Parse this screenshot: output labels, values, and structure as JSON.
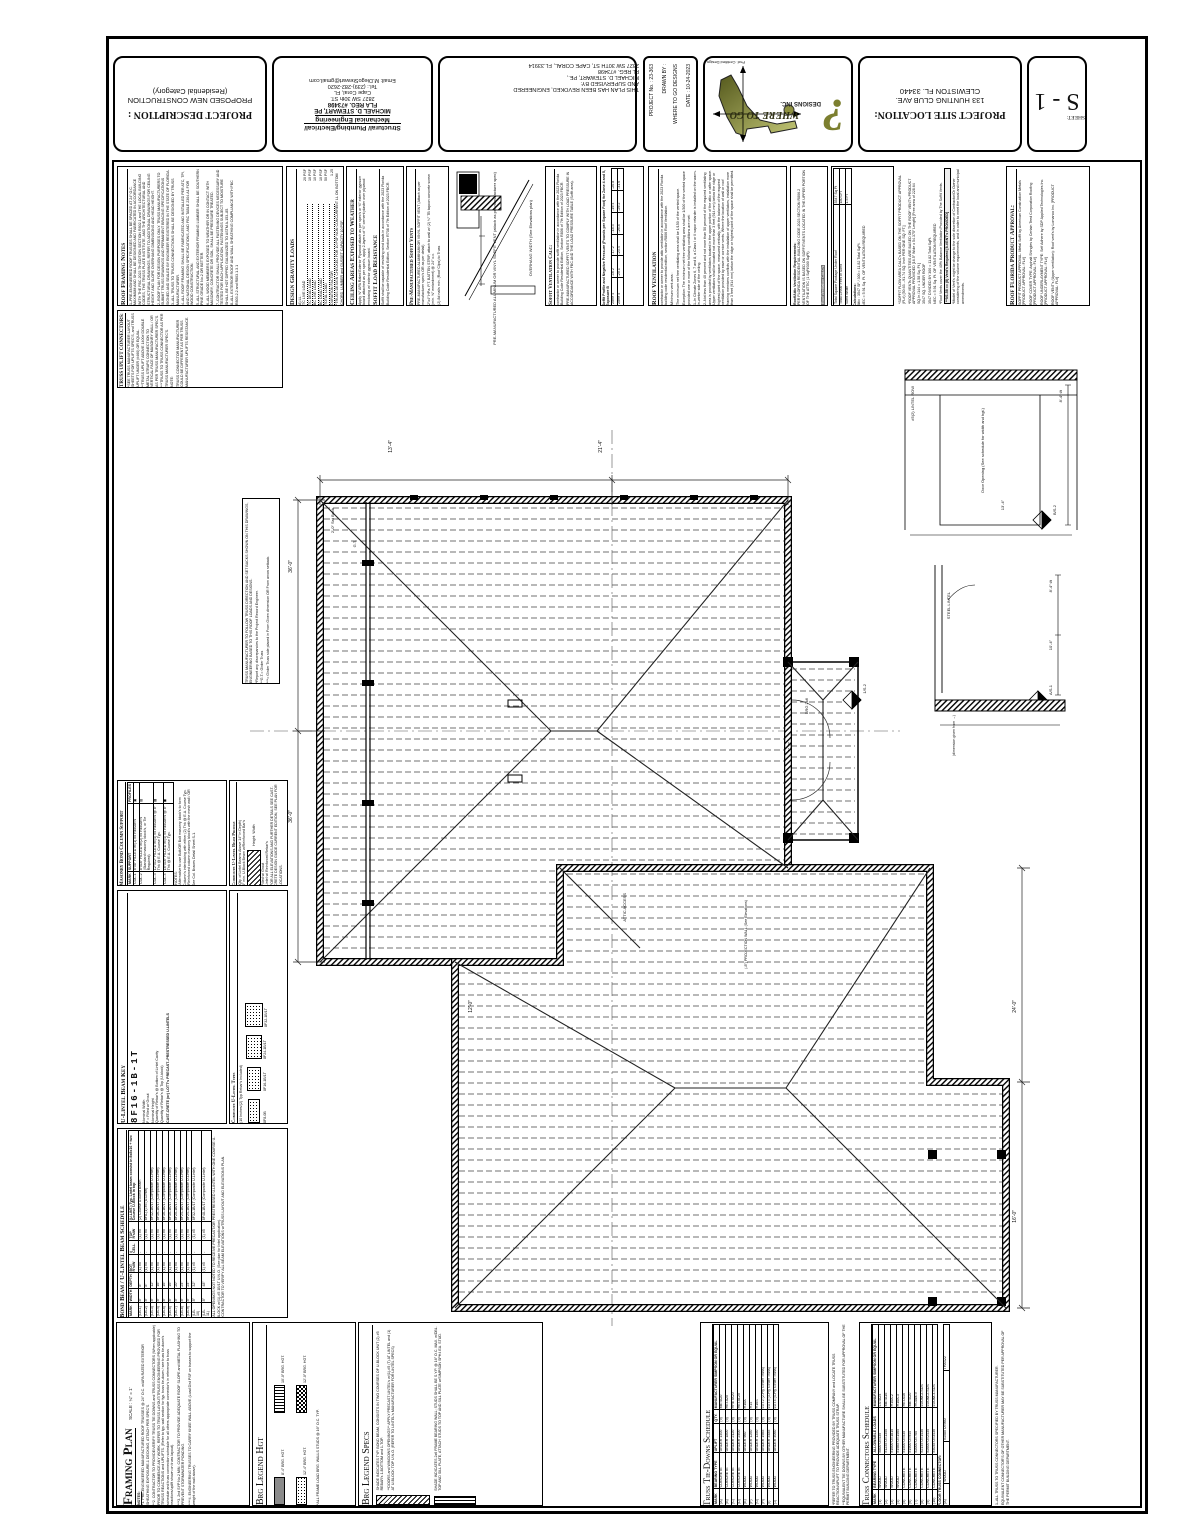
{
  "title_strip": {
    "project_description": {
      "label": "PROJECT DESCRIPTION :",
      "line1": "PROPOSED NEW CONSTRUCTION",
      "line2": "(Residential Category)"
    },
    "engineer": {
      "firm1": "Structural/ Plumbing/Electrical/",
      "firm2": "Mechanical Engineering",
      "name": "MICHAEL D. STEWART, PE",
      "reg": "FLA REG. #73498",
      "addr": "2827 SW 30th ST.",
      "city": "Cape Coral, FL",
      "tel": "Tel.: (239)-282-2620",
      "email": "Email: M.DiegoStewart@gmail.com"
    },
    "revision": {
      "l1": "THIS PLAN HAS BEEN REVOKED, ENGINEERED",
      "l2": "AND SUPERVISED BY:",
      "l3": "MICHAEL D. STEWART, PE.,",
      "l4": "FL REG. #73498",
      "l5": "2827 SW 30TH ST, CAPE CORAL, FL.33914"
    },
    "info": {
      "project_no": "PROJECT No. :  23-363",
      "drawn_by": "DRAWN BY :",
      "drawn_by_value": "WHERE TO GO DESIGNS",
      "date": "DATE :  10-24-2023"
    },
    "logo": {
      "title": "WHERE TO GO",
      "subtitle": "DESIGNS INC.",
      "tagline": "Prof. Certified Design"
    },
    "location": {
      "label": "PROJECT SITE LOCATION:",
      "l1": "133 HUNTING CLUB AVE.",
      "l2": "CLEWISTON FL. 33440"
    },
    "sheet": {
      "label": "SHEET:",
      "number": "S - 1"
    }
  },
  "notes": {
    "roof_framing": {
      "title": "Roof Framing Notes",
      "items": [
        "1–PRE-ENGINEERED ROOF TRUSSES SHALL BE SPACED AT 24″ O.C. MAXIMUM AND SHALL BE DESIGNED AND FABRICATED IN ACCORDANCE WITH THE FBC 2023 7th EDITION SECTION R802.1 and THE LOCAL BUILDING CODES, THE TRUSS PLATE INSTITUTE, AND THE ARCHITECTURAL AND STRUCTURAL DRAWINGS. REFER TO ADDITIONAL DRAWINGS FOR CEILING HEIGHT AND SLOPE OVERHANG DIMENSIONS AND HEAD HEIGHT.",
        "2–ROOF PLAN FOR DESIGN PURPOSES ONLY. TRUSS MANUFACTURERS TO SUBMIT TRUSS DRAWINGS AND PERMANENT BRACING SPECIFICATIONS SIGNED AND SEALED BY ENGINEER REGISTERED IN THE STATE OF FLORIDA.",
        "3–ALL TRUSS TO TRUSS CONNECTIONS SHALL BE DESIGNED BY TRUSS MANUFACTURER.",
        "4–ALL ROOF FRAMING SHALL BE FABRICATED AND INSTALLED PER ATC, TPI, AND NATIONAL DESIGN SPECIFICATIONS, AND FBC TABLE 2304.A1 FOR WOOD CONSTRUCTION.",
        "5–ALL STRUCTURAL AND EXTERIOR FRAMING LUMBER SHALL BE SOUTHERN PINE GRADE No.2 OR BETTER.",
        "6–ALL WOOD MEMBERS EXPOSED TO WEATHER OR IN CONTACT WITH MASONRY, CONCRETE OR SOIL, SHALL BE PRESSURE TREATED.",
        "7–CONTRACTOR SHALL PROVIDE ALL FASTENING DEVICES NECESSARY AND TESTED FOR EACH APPLICATION. FASTENINGS SUBJECT TO MOISTURE SHALL BE HOT DIPPED GALVANIZED TO ASTM A-153–85.",
        "8–ALL EXTERIOR ROOF AND WALL SHEATHING COMPLIANCE WITH FBC R803.2.2 and R803.1.3.1"
      ]
    },
    "truss_uplift": {
      "title": "TRUSS UPLIFT CONNECTORS:",
      "lines": [
        "*SEE TRUSS MANUFACTURER LAYOUT SHEETS FOR UPLIFTS SPEC'S, and TRUSS UPLIFT UNDER (#460) OR EQUAL.",
        "**TRUSS UPLIFT ABOVE 1400# DOUBLE METAL STRAPS CONNECTION TO VERTICAL FACE OF MASONRY WALL / OR AS PER TRUSS MANUFACTURER SPEC'S.",
        "***TRUSS TO TRUSS CONNECTOR AS PER TRUSS MANUFACTURER SPEC'S.",
        "NOTE:",
        "TRUSS CONNECTOR MANUFACTURER COULD BE DIFFERENT AS PER TRUSS MANUFACTURER UPLIFTS RESISTANCE."
      ]
    },
    "gravity": {
      "title": "Design Gravity Loads",
      "sub": "A) LL :",
      "rows": [
        [
          "TC LIVE LOAD",
          "20 PSF"
        ],
        [
          "TC DEAD LOAD",
          "10 PSF"
        ],
        [
          "BC LIVE LOAD",
          "10 PSF"
        ],
        [
          "BC DEAD LOAD",
          "10 PSF"
        ],
        [
          "TOTAL LOAD",
          "50 PSF"
        ],
        [
          "DURATION FACTOR",
          "1.25"
        ]
      ],
      "foot": "*TRUSS DESIGN CHECKED FOR 10 PSF NON CONCURRENT LL ON BOTTOM CHORD, LUMBER and GUSSET CAPACITY 10 PSF."
    },
    "ceiling": {
      "title": "Ceiling Areas Exposed to Weather",
      "body": "Apply ⅝″ APA Rated Exterior Plywood attach as per spec's or ⅝″ exterior gypsum board attached as per spec's, apply 2-layers of ⅝″ cement plaster over plywood enclosing w/ exterior gypsum board.",
      "title2": "Soffit Load Resistance",
      "body2": "Soffit shall be capable of resisting wind loads in accordance with the 2023 Florida Building Code Residential Edition, Section R708 of 7th Edition of 2023 FBCR."
    },
    "soffit_vents": {
      "title": "Pre-Manufactured Soffit Vents",
      "lines": [
        "PRE-MANUFACTURED ALUMINUM OR VINYL SOFFIT VENT (Attach as per manufacturer spec's OR as per detail)",
        "2″x4″ HPa. P.T. BATTEN STRIP, attach to wall w/ (2) ¼″ TB tapcon concrete screw (min. ⅝″ embedment) @ 24″ o.c.",
        "(2) 8d nails min. (Roof Clips) to Truss"
      ]
    },
    "detail_labels": {
      "a": "PRE-MANUFACTURED ALUMINUM OR VINYL SOFFIT VENT (attach as per manufacturer spec)",
      "b": "OVERHANG WIDTH (See Elevations plan)"
    },
    "soffit_calc": {
      "title": "Soffit Ventilation Calc:",
      "body": "contractor or owner to provide soffit ventilation in accordance with the 2023 Florida Building Code Residential Edition, Section R806 of 7th Edition of 2023 FBCR.",
      "body2": "PRE-MANUFACTURED SOFFIT VENTS TO COMPLY WITH LOAD PRESSURE IN ACCORDANCE WITH FBC AND THE LOAD PRESSURE TABLE (Soffit area)."
    },
    "pressure_table": {
      "title": "Soffit Profile and Negative Pressure (Pounds per Square Foot) for Zone 4 and 5, Exposure B",
      "rows": [
        [
          "Zone 4",
          "-16.2",
          "-17.2",
          "-18.3",
          "-19.4",
          "-20.8"
        ],
        [
          "Zone 5",
          "-20.1",
          "-23.4",
          "-26.8",
          "-29.2",
          "-31.6"
        ]
      ]
    },
    "roof_vent": {
      "title": "Roof Ventilation",
      "lines": [
        "contractor or owner to provide attic ventilation in accordance with the 2023 Florida building code residential edition, section R806 Roof Ventilation.",
        "Minimum vent area :",
        "The minimum net free ventilating area shall be 1/150 of the vented space.",
        "Exception: The minimum net free ventilating area shall be 1/300 of the vented space provided one or more of the following conditions are met:",
        "1–In Climate Zones 6, 7 and 8, a Class I or II vapor retarder is installed on the warm-in-winter side of the ceiling.",
        "2–Not less than 40 percent and not more than 50 percent of the required ventilating area is provided by ventilators located in the upper portion of the attic or rafter space. Upper ventilators shall be located not more than 3 feet (914 mm) below the ridge or highest point of the space, measured vertically, with the balance of the required ventilation provided by eave or cornice vents. Where the location of wall or roof framing members conflicts with the installation of upper ventilators, installation more than 3 feet (914 mm) below the ridge or highest point of the space shall be permitted."
      ]
    },
    "attic_req": {
      "title": "Roof/Attic Ventilation Requirements:",
      "body": "PER FLORIDA RESIDENTIAL BUILDING CODE 2023 SECTION R806.2 VENTILATION IS BASED ON SOFFIT/VENTS LOCATED IN THE UPPER PORTION OF THE ATTIC (1 SqFt/300 SqFt)",
      "link": "Roof Ventilation CALC's"
    },
    "vent_calc": {
      "rows": [
        [
          "Total Square Footage Under Roof",
          "3547 Sq Ft"
        ],
        [
          "Total Linear Feet of Soffit",
          "180 LFT"
        ],
        [
          "Soffit Width",
          "1.5 FT"
        ]
      ],
      "calc_title": "Calculations:",
      "calc_lines": [
        "Attic : 3547 SF / 300 = 11.82 Total SqFt.",
        "NEC = 5.91 Sq. Ft. OF VENTILATION REQUIRED"
      ]
    },
    "flow_notes": {
      "lines": [
        "*SOFFIT FLOW AREA CALC's BASED ON THE SOFFIT PRODUCT APPROVAL (FL#) [50.63→91.74 SQ. Inch PER ONE SQ. FT.]",
        "*ROOF VENTs QUANTITIES ARE BASED ON THE ROOF VENT's PRODUCT APPROVAL PROVIDED [16.5″ Wide x 54.375″ Length] [Free area of 228.64 SQ.In./144 = 1.58 Sq. Ft.]",
        "3547 SQ. UNDER ROOF",
        "3547 DIVIDED BY 300 = 11.82 Total SqFt.",
        "NEC = 5.91 Sq. Ft. OF VENTILATION REQUIRED",
        "*Roof Vents cover the 40% Balance Ventilation Provided by The Soffit Vents."
      ],
      "highlight": "**9/1.58 == (8) Vent's Required  [8-VENT's PROVIDED]",
      "foot": "*Model of Vent's might be change to the sole discretion of Contractor/Or Owner considering of the volume requirements, and in order to meet the local and municipal amendments."
    },
    "product_approval": {
      "title": "Roof Florida Product Approval:",
      "lines": [
        "SOFFIT PRODUCT APPROVAL: Metal Soffit by American Construction Metals [PRODUCT APPROVAL: FL#]",
        "ROOF COVER TYPE: Asphalt Shingles by Certain Teed Corporation Roofing [PRODUCT APPROVAL: FL#]",
        "ROOF UNDERLAYMENT TYPE: Self Adhere by SDP Applied Technologies Inc. [PRODUCT APPROVAL: FL#]",
        "ROOF VENT's (Upper ventilation): Roof vent's by Lomanco Inc. [PRODUCT APPROVAL: FL#]"
      ]
    },
    "girder": {
      "lines": [
        "TRUSS MANUFACTURER TO FOLLOW TRUSS DIRECTION AND SET BACKS SHOWN ON THIS DRAWINGS, ENGINEERING BASED TO THIS ROOF LOADS AND DESIGNS.",
        "*Report any discrepancies to the Project Record Engineer.",
        "**G.T.= Girder Truss",
        "***= Girder Truss side placed in From Given dimension OR From arrow setback."
      ]
    }
  },
  "plan": {
    "labels": {
      "d36a": "36'-0″",
      "d36b": "36'-0″",
      "d134": "13'-4″",
      "d214": "21'-4″",
      "d240": "24'-0″",
      "d160": "16'-0″",
      "d120": "12'-0″",
      "d32": "3'-2″",
      "gt": "G.T.",
      "brg26": "BRG 2x6",
      "setback": "2'-0″ Set Back",
      "attic": "ATTIC ACCESS",
      "projection": "(-8″) PROJECTION WALL (See Elevations)",
      "m1": "1/S-2",
      "m2": "B/S-2",
      "m3": "A/S-1"
    },
    "detail1": {
      "lintel": "#5(2) LINTEL ROW",
      "door": "Door Opening (See schedule for width and hgt.)",
      "dim": "8'-4″ t/t",
      "dim2": "13'-4″"
    },
    "detail2": {
      "steel": "STEEL LINTEL",
      "dim": "10'-4″",
      "dim2": "8'-4″ t/t",
      "cap": "(dimension given from →)"
    }
  },
  "legends": {
    "framing": {
      "title": "Framing Plan",
      "scale": "SCALE : ¼″ = 1'",
      "notes_label": "NOTES:",
      "notes": [
        "*1. PRE-ENGINEERED MANUFACTURED ROOF TRUSSES @ 24″ O.C. w/APA RATED EXTERIOR SHEATHING EXPOSURE-1 DECKING, ATTACH PER SPEC'S.",
        "**2. CONTRACTOR TO PROVIDE/VERIFY TRUSS TIE DOWNS and TRUSS CONNECTORS (When applicable) PRIOR TO COMMENCE ANY WORK. REFER TO TRUSS LAYOUT/TRUSS ENGINEERING PROVIDED FOR TRUSS REACTIONS and UPLIFTS. (Refer to typ. wall section for typ. truss tie-down / see truss tie-down's schedule and truss connection schedule for all others appropriate connector's in reference to truss reactions/uplift shown on truss layout).",
        "***3. 2nd SYP No.2 MIN. CONTRACTOR TO PROVIDE ADEQUATE ROOF SLOPE and METAL FLASHING TO PREVENT STORMWATER PONDING.",
        "****4. ENGINEERING TRUSSES TO CARRY KNEE WALL ABOVE (Load Dist PSF on trusses to support the weight of the wall above)."
      ]
    },
    "hgt": {
      "title": "Brg Legend Hgt",
      "i1": "8'-4″ BRG. HGT.",
      "i2": "10'-0″ BRG. HGT.",
      "i3": "12'-0″ BRG. HGT.",
      "i4": "12'-4″ BRG. HGT.",
      "note": "*ALL FRAME LOAD BRG. WALLS STUDS @ 16″ O.C. TYP."
    },
    "spec": {
      "title": "Brg Legend Specs",
      "i1": "SHADE INDICATES TYP. BOND BEAM, CONSISTS IN TWO COURSES OF U-BLOCK UNIT (2) #5 REBAR's 1-BOTTOM and 1-TOP.",
      "i1b": "**DOORS and WINDOWS OPENINGS** APPLY PRECAST LINTEL's w/(1)-#5 (T) AT LINTEL and (1) AT U-BLOCK TOP U.N.O. (REFER TO LINTEL's MANUFACTURER FOR LINTEL SPECS)",
      "i2": "SHADE INDICATES 2x6 FRAME BEARING WALL; STUDS SHALL BE S.Y.P. @ 16″ O.C. MAX. w/DBL. TOP AND SILL PLATE, ATTACH STUDS TO TOP AND SILL PLATE w/SIMPSON SPH4 EA. STUD."
    }
  },
  "schedules": {
    "masonry_col": {
      "title": "Masonry Bond Column Support",
      "cols": [
        "MARK",
        "SUPPORT",
        "PROFILES"
      ],
      "rows": [
        [
          "COL-1",
          "8″x8″ FILLED w/(1) #5 REBAR's",
          "▣"
        ],
        [
          "COL-2",
          "8″x16″ FILLED w/(2) #5 REBAR's (Standard masonry block's, or Tie Required)",
          "▥"
        ],
        [
          "COL-3",
          "12″x12″ FILLED w/(4) #5 REBAR's @ 8″ Thk @ E.A. Course Typ.",
          "▩"
        ],
        [
          "COL-4",
          "16″x16″ FILLED w/(4) #5 REBAR's @ 8″ Thk @ E.A. Course Typ.",
          "◼"
        ]
      ],
      "notes": [
        "*NOTES:",
        "*Alternative to use Bolt/OR Bolt masonry block's to form Column's interlocking with either (2) Thk @ E.A. Course Typ.",
        "*Reinforced column masonry block's with the mesh wall / OR See Col. Braces Detail Sheet S-1."
      ]
    },
    "lintel_profile": {
      "title": "Composite U-Lintel Beam Profile",
      "sub": "(Qty. of Lintel Beams Above 14″ in Depth)",
      "sub2": "8″ min. U-Block Beam w/Reinforced Bar's",
      "lbl1": "Height",
      "lbl2": "Width",
      "lbl3": "Filled w/ Grout",
      "lbl4": "Lintel w/ Reinforced Rebar's",
      "foot": "FOR ALL ELEVATIONS AND FURTHER DETAILS SEE CAST-CRETE DESIGN GUIDE CURRENT EDITION, SEE PLAN FOR LOCATIONS."
    },
    "lintel_key": {
      "title": "U-Lintel Beam Key",
      "mark": "8F16-1B-1T",
      "k1": "Nominal Width",
      "k2": "F = Filled w/ Grout",
      "k3": "Nominal Height",
      "k4": "Quantity of Rebar's @ Bottom of Lintel Cavity",
      "k5": "Quantity of Rebar's @ Top (U-block)",
      "foot": "CAST-CRETE (or) LOTT's PRECAST–PRESTRESSED U-LINTELS"
    },
    "lintel_types": {
      "title": "Composite U-Lintel Types",
      "sub": "(10 Inches/(2) Typ Rebar's Included)",
      "t1": "8F8-0B",
      "t2": "8F16-1B/1T",
      "t3": "8F24-1B/1T",
      "t4": "8F32-1B/1T"
    },
    "bond_beam": {
      "title": "Bond Beam / U-Lintel Beam Schedule",
      "cols": [
        "MARK",
        "WIDTH",
        "DEPTH",
        "BOT R's/W",
        "# CELL",
        "TOP R's/W",
        "(U-LINT.) Typ. Lintel beam consist in 8x8x16 + two Course U-Block in top"
      ],
      "rows": [
        [
          "(LB-1)",
          "8″",
          "8″",
          "(1) #5",
          "-",
          "(1) #5",
          "(2) Course U-Bond Beam"
        ],
        [
          "(LB-2)",
          "8″",
          "8″",
          "(1) #5",
          "-",
          "(1) #5",
          "8F8-(1) #5 (U-Lintel)"
        ],
        [
          "(LB-3)",
          "8″",
          "12″",
          "(1) #5",
          "-",
          "(1) #5",
          "8F12-1B/1T (Composite U-Lintel)"
        ],
        [
          "(LB-4)",
          "8″",
          "16″",
          "(1) #5",
          "-",
          "(1) #5",
          "8F16-1B/1T (Composite U-Lintel)"
        ],
        [
          "(LB-5)",
          "8″",
          "16″",
          "(1) #5",
          "-",
          "(1) #5",
          "8F16-1B/1T (Composite U-Lintel)"
        ],
        [
          "(LB-6)",
          "8″",
          "16″",
          "(1) #5",
          "-",
          "(1) #5",
          "8F16-1B/1T (Composite U-Lintel)"
        ],
        [
          "(LB-7)",
          "8″",
          "20″",
          "(1) #5",
          "-",
          "(1) #5",
          "8F20-1B/1T (Composite U-Lintel)"
        ],
        [
          "(LB-8)",
          "8″",
          "24″",
          "(1) #5",
          "-",
          "(1) #5",
          "8F24-1B/1T (Composite U-Lintel)"
        ],
        [
          "(LB-9)",
          "8″",
          "24″",
          "(1) #5",
          "-",
          "(1) #5",
          "8F24-1B/1T (Composite U-Lintel)"
        ],
        [
          "(LB-10)",
          "8″",
          "32″",
          "(1) #5",
          "-",
          "(1) #5",
          "8F32-1B/1T (Composite U-Lintel)"
        ],
        [
          "(LB-11)",
          "8″",
          "48″",
          "(1) #5",
          "-",
          "(1) #5",
          "8F48-1B/1T (Composite U-Lintel)"
        ]
      ],
      "notes": [
        "*ALL OPENINGS NOT NOTED TO RECEIVE PRECAST/OR PRESTRESSED U-LINTEL WITH ONE COURSE U-BLOCK w/(1)-#5 1B/1T U.N.O. (See plan for lintel application).",
        "*CONTRACTOR TO VERIFY ALL BEAM ELEVATIONS w/TRUSS LAYOUT AND ELEVATIONS PLAN."
      ]
    },
    "tie_downs": {
      "title": "Truss Tie-Downs Schedule",
      "cols": [
        "MARK",
        "BEARING TYPE",
        "UPLIFT",
        "QTY.",
        "MANUFACTURER SIMPSON OR EQUAL"
      ],
      "rows": [
        [
          "(A)",
          "CONCRETE",
          "UNDER 1400",
          "(9)",
          "META20"
        ],
        [
          "(B)",
          "CONCRETE",
          "UNDER 1800",
          "(9)",
          "HETA20"
        ],
        [
          "(C)",
          "CONCRETE",
          "UNDER 2120",
          "(9)",
          "HHETA20"
        ],
        [
          "(D)",
          "CONCRETE",
          "UNDER 2400",
          "(9)",
          "HETAL20"
        ],
        [
          "(E)",
          "WOOD",
          "UNDER 960",
          "(9)",
          "H10A"
        ],
        [
          "(F)",
          "WOOD",
          "UNDER 1260",
          "(9)",
          "H14"
        ],
        [
          "(G)",
          "WOOD",
          "UNDER 1350",
          "(9)",
          "H16S"
        ],
        [
          "(H)",
          "WOOD",
          "UNDER 1985",
          "(9)",
          "LGT2 (2-Ply Girder Truss)"
        ],
        [
          "(I)",
          "WOOD",
          "UNDER 3485",
          "(9)",
          "LGT3 (3-Ply Girder Truss)"
        ],
        [
          "(J)",
          "WOOD",
          "UNDER 4060",
          "(9)",
          "LGT4 (4-Ply Girder Truss)"
        ]
      ],
      "notes": [
        "*REFER TO TRUSS ENGINEERING PROVIDED BY TRUSS COMPANY and LOCATE TRUSS REACTION/UPLIFT TO PROVIDE ADEQUATE TRUSS STRAP.",
        "**EQUIVALENT TIE DOWNS BY OTHER MANUFACTURE SHALL BE SUBSTITUTED FOR APPROVAL OF THE PERMIT BUILDING DEPARTMENT."
      ]
    },
    "connectors": {
      "title": "Truss Connectors Schedule",
      "cols": [
        "MARK",
        "BEARING TYPE",
        "ALLOWABLE LOADS",
        "MANUFACTURER SIMPSON OR EQUAL"
      ],
      "rows": [
        [
          "(1)",
          "WOOD",
          "#800 U=435",
          "LSTA24"
        ],
        [
          "(2)",
          "WOOD",
          "#1235 U=1350",
          "META16"
        ],
        [
          "(3)",
          "WOOD",
          "#1600 U=1815",
          "H10A-2"
        ],
        [
          "(4)",
          "WOOD",
          "#1985 U=1465",
          "H10A-3"
        ],
        [
          "(5)",
          "CONCRETE",
          "#1500 U=535",
          "HETA16"
        ],
        [
          "(6)",
          "CONCRETE",
          "#1900 U=945",
          "META20"
        ],
        [
          "(7)",
          "CONCRETE",
          "#2000 U=760",
          "HGAM-9"
        ],
        [
          "(8)",
          "CONCRETE",
          "#2145 U=1430",
          "LGUM-2-SDS"
        ],
        [
          "(9)",
          "CONCRETE",
          "#2600 U=2435",
          "LGUM-2-SDS"
        ],
        [
          "(10)",
          "CONCRETE",
          "#3035 U=3430",
          "LGUM-3-SDS"
        ]
      ],
      "floor_title": "FLOOR TRUSS CONNECTOR:",
      "floor_row": [
        "(A)",
        "WOOD",
        "#1580 U=960",
        "THA422"
      ],
      "notes": [
        "1–ALL TRUSS TO TRUSS CONNECTORS SPECIFIED BY TRUSS MANUFACTURER.",
        "EQUIVALENT CONNECTOR'S OF OTHER MANUFACTURER MAY BE SUBSTITUTED PER APPROVAL OF THE PERMIT BUILDING DEPARTMENT."
      ]
    }
  }
}
